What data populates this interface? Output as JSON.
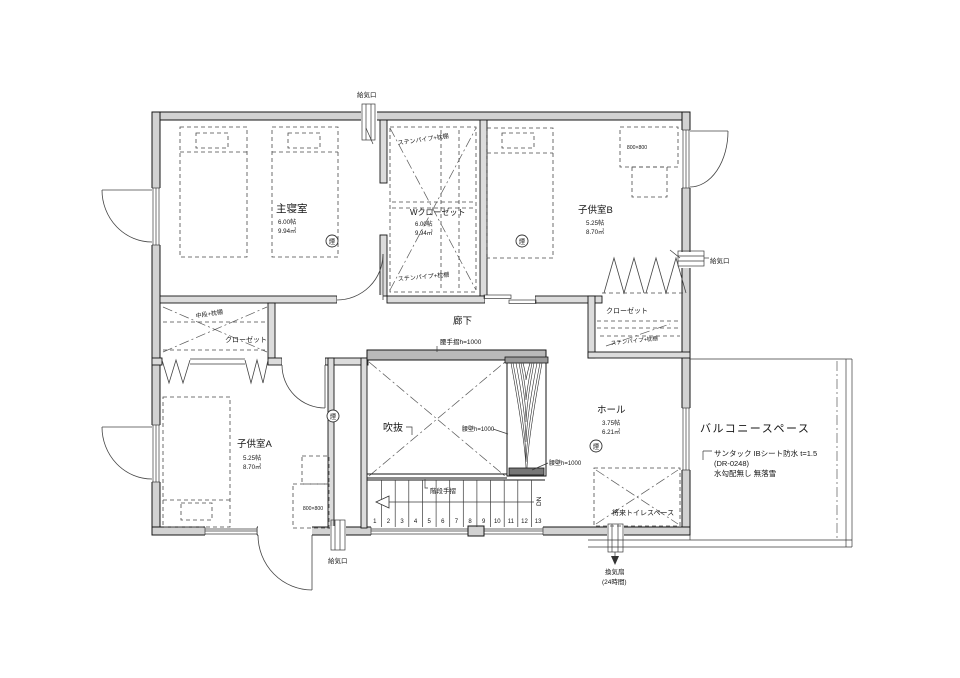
{
  "plan": {
    "rooms": {
      "master_bedroom": {
        "name": "主寝室",
        "tatami": "6.00帖",
        "area": "9.94㎡"
      },
      "walkin_closet": {
        "name": "Wクローゼット",
        "tatami": "6.00帖",
        "area": "9.94㎡"
      },
      "kids_room_b": {
        "name": "子供室B",
        "tatami": "5.25帖",
        "area": "8.70㎡"
      },
      "kids_room_a": {
        "name": "子供室A",
        "tatami": "5.25帖",
        "area": "8.70㎡"
      },
      "hall": {
        "name": "ホール",
        "tatami": "3.75帖",
        "area": "6.21㎡"
      },
      "corridor": {
        "name": "廊下"
      },
      "void": {
        "name": "吹抜"
      },
      "closet_left": {
        "name": "クローゼット",
        "note": "中段+枕棚"
      },
      "closet_right": {
        "name": "クローゼット",
        "note": "ステンパイプ+枕棚"
      },
      "wic_notes": {
        "top": "ステンパイプ+枕棚",
        "bottom": "ステンパイプ+枕棚"
      },
      "future_toilet": {
        "name": "将来トイレスペース"
      }
    },
    "balcony": {
      "name": "バルコニースペース",
      "note1": "サンタック IBシート防水 t=1.5",
      "note2": "(DR-0248)",
      "note3": "水勾配無し 無落雪"
    },
    "labels": {
      "supply_air_top": "給気口",
      "supply_air_right": "給気口",
      "supply_air_bottom": "給気口",
      "exhaust_fan_line1": "換気扇",
      "exhaust_fan_line2": "(24時間)",
      "handrail_waist": "腰手摺h=1000",
      "wall_waist_1": "腰壁h=1000",
      "wall_waist_2": "腰壁h=1000",
      "stair_handrail": "階段手摺",
      "stair_direction": "DN",
      "desk_size_a": "800×800",
      "desk_size_b": "800×800",
      "smoke_detector": "煙"
    },
    "stairs": {
      "numbers": [
        "1",
        "2",
        "3",
        "4",
        "5",
        "6",
        "7",
        "8",
        "9",
        "10",
        "11",
        "12",
        "13"
      ]
    },
    "colors": {
      "wall_fill": "#d2d2d2",
      "line": "#161616"
    }
  }
}
